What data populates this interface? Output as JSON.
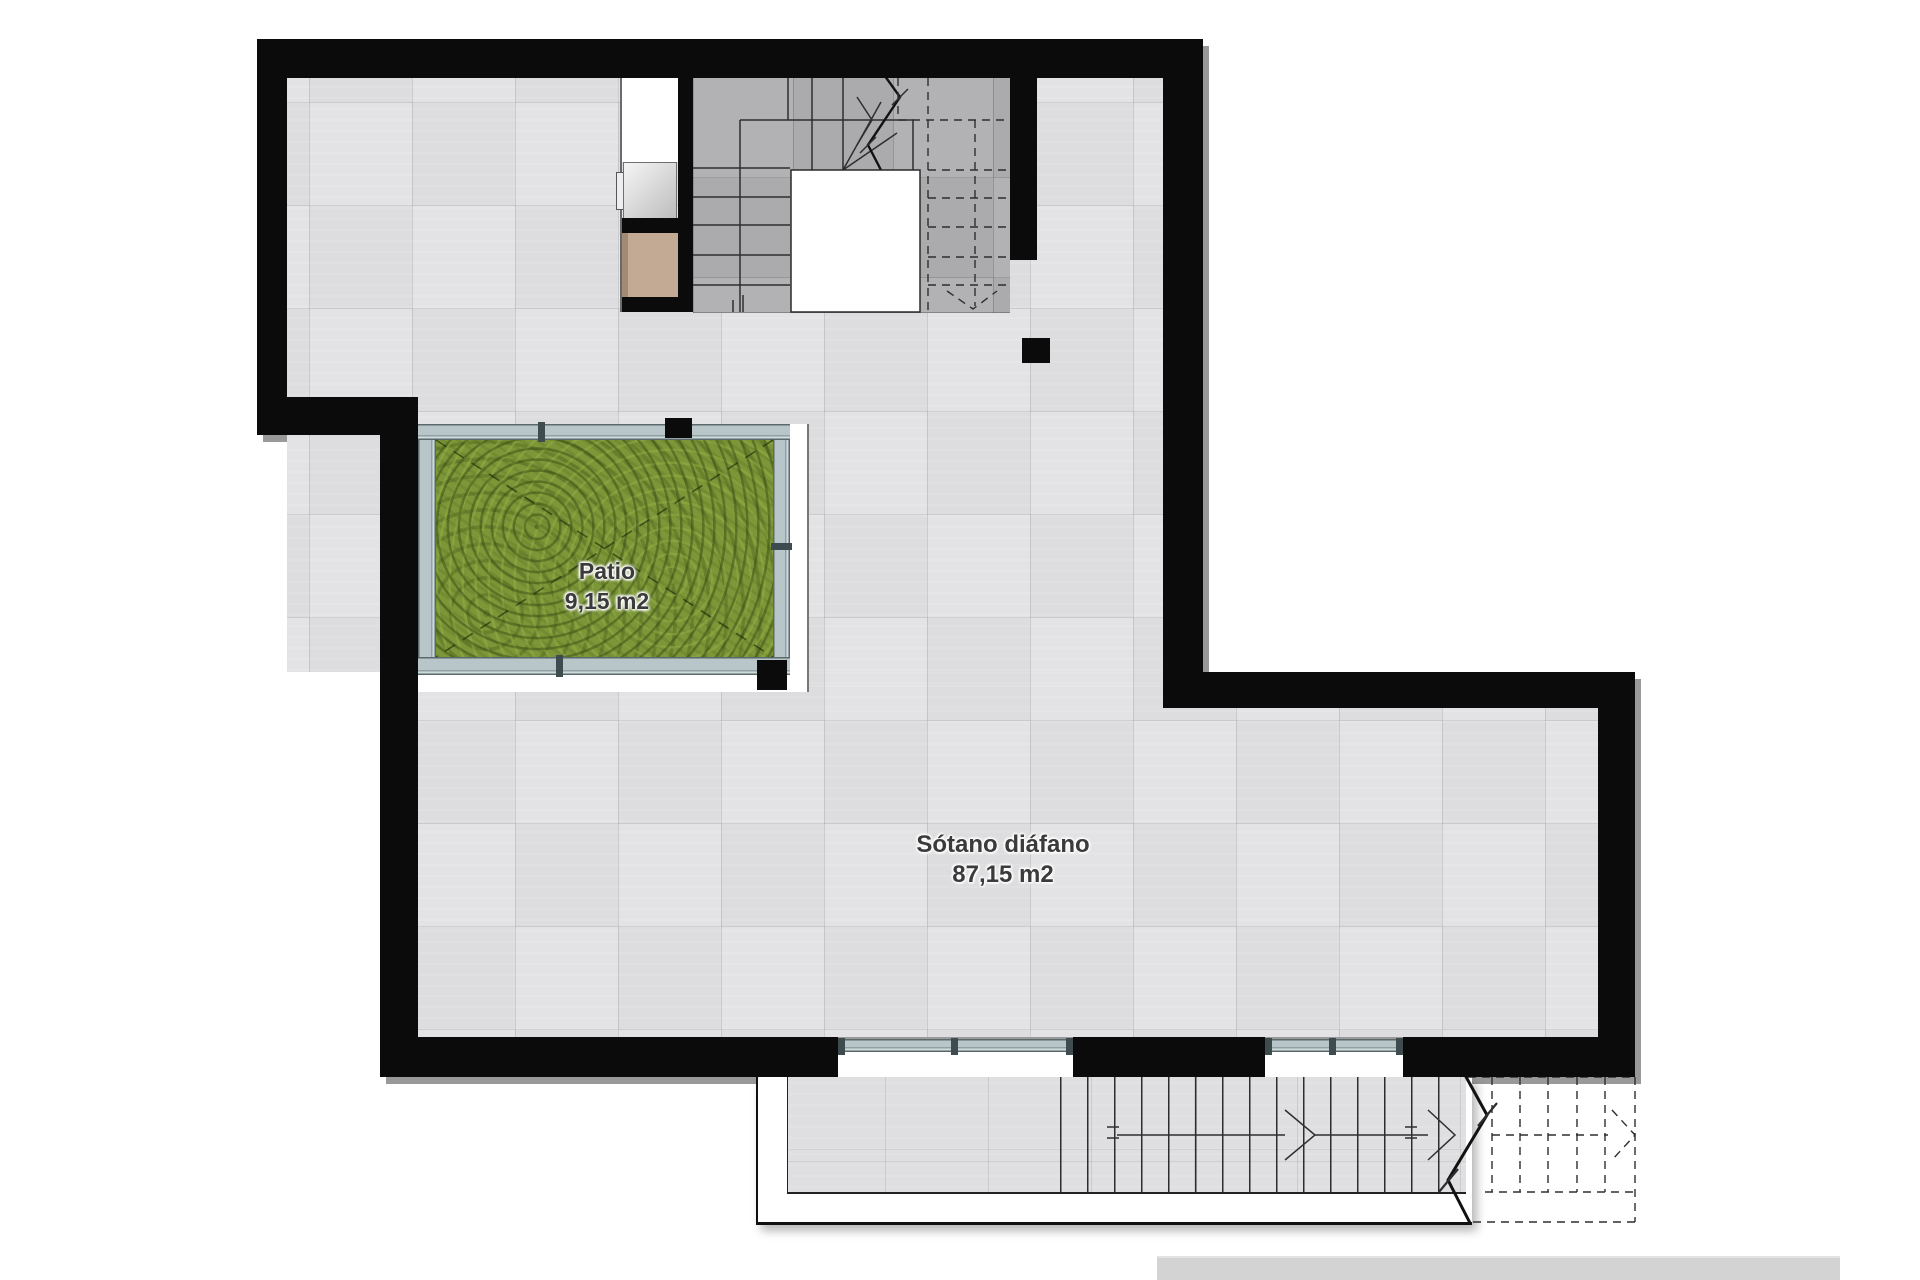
{
  "plan": {
    "title": "Basement floor plan",
    "rooms": [
      {
        "name": "Patio",
        "area": "9,15 m2"
      },
      {
        "name": "Sótano diáfano",
        "area": "87,15 m2"
      }
    ],
    "palette": {
      "wall": "#0b0b0b",
      "floor_tile": "#e3e3e5",
      "stair_tile": "#b2b2b4",
      "terrace_tile": "#dfdfe1",
      "grass": "#7c9638",
      "glazing": "#b8c6c9",
      "appliance_gray": "#d9d9d9",
      "cabinet_tan": "#c2aa95",
      "label_text": "#3b3b3b",
      "watermark_bar": "#d3d3d3"
    },
    "features": {
      "interior_stair": "U-shaped stair with break line and dashed upper flight",
      "exterior_stair": "straight stair with break line and dashed continuation",
      "windows": 2,
      "patio_enclosure": "glazed curtain wall with black corner columns"
    }
  }
}
